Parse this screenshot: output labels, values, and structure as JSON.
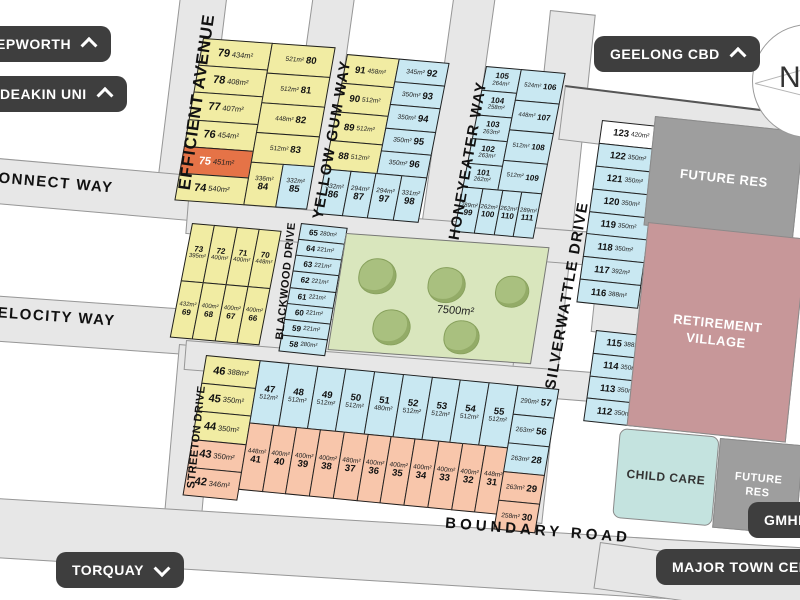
{
  "pills": {
    "epworth": {
      "label": "EPWORTH",
      "chevron": "up"
    },
    "deakin_uni": {
      "label": "DEAKIN UNI",
      "chevron": "up"
    },
    "geelong_cbd": {
      "label": "GEELONG CBD",
      "chevron": "up"
    },
    "torquay": {
      "label": "TORQUAY",
      "chevron": "down"
    },
    "gmhba": {
      "label": "GMHBA",
      "chevron": "none"
    },
    "major_town_centre": {
      "label": "MAJOR TOWN CENTRE",
      "chevron": "none"
    }
  },
  "streets": {
    "efficient_avenue": "EFFICIENT  AVENUE",
    "yellow_gum_way": "YELLOW GUM WAY",
    "honeyeater_way": "HONEYEATER WAY",
    "silverwattle_drive": "SILVERWATTLE DRIVE",
    "blackwood_drive": "BLACKWOOD DRIVE",
    "streeton_drive": "STREETON DRIVE",
    "connect_way": "CONNECT WAY",
    "velocity_way": "VELOCITY WAY",
    "boundary_road": "BOUNDARY  ROAD"
  },
  "parcels": {
    "future_res_top": "FUTURE RES",
    "retirement_village": "RETIREMENT VILLAGE",
    "child_care": "CHILD CARE",
    "future_res_bottom": "FUTURE RES"
  },
  "park": {
    "area": "7500m²",
    "tree_count": 5
  },
  "compass": {
    "label": "N"
  },
  "colors": {
    "yellow": "#f1eca3",
    "blue": "#c9e8f2",
    "orange": "#e57347",
    "pink": "#f8c6ab",
    "white": "#ffffff",
    "road": "#e7e7e7",
    "park": "#d9e6bd",
    "tree": "#a9c07f",
    "retirement": "#c79799",
    "future_res": "#9e9e9e",
    "child_care": "#c4e3df",
    "pill": "#3e3e3e"
  },
  "lot_groups": {
    "a_left": {
      "mode": "na",
      "cells": [
        {
          "n": "79",
          "a": "434m²",
          "c": "yellow"
        },
        {
          "n": "78",
          "a": "408m²",
          "c": "yellow"
        },
        {
          "n": "77",
          "a": "407m²",
          "c": "yellow"
        },
        {
          "n": "76",
          "a": "454m²",
          "c": "yellow"
        },
        {
          "n": "75",
          "a": "451m²",
          "c": "orange"
        },
        {
          "n": "74",
          "a": "540m²",
          "c": "yellow"
        }
      ]
    },
    "a_right": {
      "mode": "an",
      "cells": [
        {
          "n": "80",
          "a": "521m²",
          "c": "yellow"
        },
        {
          "n": "81",
          "a": "512m²",
          "c": "yellow"
        },
        {
          "n": "82",
          "a": "448m²",
          "c": "yellow"
        },
        {
          "n": "83",
          "a": "512m²",
          "c": "yellow"
        }
      ]
    },
    "a_rb": {
      "mode": "AN",
      "cells": [
        {
          "n": "84",
          "a": "336m²",
          "c": "yellow"
        },
        {
          "n": "85",
          "a": "332m²",
          "c": "blue"
        }
      ]
    },
    "b_left": {
      "mode": "na",
      "cells": [
        {
          "n": "91",
          "a": "458m²",
          "c": "yellow"
        },
        {
          "n": "90",
          "a": "512m²",
          "c": "yellow"
        },
        {
          "n": "89",
          "a": "512m²",
          "c": "yellow"
        },
        {
          "n": "88",
          "a": "512m²",
          "c": "yellow"
        }
      ]
    },
    "b_right": {
      "mode": "an",
      "cells": [
        {
          "n": "92",
          "a": "345m²",
          "c": "blue"
        },
        {
          "n": "93",
          "a": "350m²",
          "c": "blue"
        },
        {
          "n": "94",
          "a": "350m²",
          "c": "blue"
        },
        {
          "n": "95",
          "a": "350m²",
          "c": "blue"
        },
        {
          "n": "96",
          "a": "350m²",
          "c": "blue"
        }
      ]
    },
    "b_bottom": {
      "mode": "AN",
      "cells": [
        {
          "n": "86",
          "a": "332m²",
          "c": "blue"
        },
        {
          "n": "87",
          "a": "294m²",
          "c": "blue"
        },
        {
          "n": "97",
          "a": "294m²",
          "c": "blue"
        },
        {
          "n": "98",
          "a": "331m²",
          "c": "blue"
        }
      ]
    },
    "c_left": {
      "mode": "NA",
      "cells": [
        {
          "n": "105",
          "a": "264m²",
          "c": "blue"
        },
        {
          "n": "104",
          "a": "258m²",
          "c": "blue"
        },
        {
          "n": "103",
          "a": "263m²",
          "c": "blue"
        },
        {
          "n": "102",
          "a": "263m²",
          "c": "blue"
        },
        {
          "n": "101",
          "a": "262m²",
          "c": "blue"
        }
      ]
    },
    "c_right": {
      "mode": "an",
      "cells": [
        {
          "n": "106",
          "a": "524m²",
          "c": "blue"
        },
        {
          "n": "107",
          "a": "448m²",
          "c": "blue"
        },
        {
          "n": "108",
          "a": "512m²",
          "c": "blue"
        },
        {
          "n": "109",
          "a": "512m²",
          "c": "blue"
        }
      ]
    },
    "c_bottom": {
      "mode": "AN",
      "cells": [
        {
          "n": "99",
          "a": "289m²",
          "c": "blue"
        },
        {
          "n": "100",
          "a": "262m²",
          "c": "blue"
        },
        {
          "n": "110",
          "a": "262m²",
          "c": "blue"
        },
        {
          "n": "111",
          "a": "289m²",
          "c": "blue"
        }
      ]
    },
    "d_top": {
      "mode": "na",
      "cells": [
        {
          "n": "123",
          "a": "420m²",
          "c": "white"
        },
        {
          "n": "122",
          "a": "350m²",
          "c": "blue"
        },
        {
          "n": "121",
          "a": "350m²",
          "c": "blue"
        },
        {
          "n": "120",
          "a": "350m²",
          "c": "blue"
        },
        {
          "n": "119",
          "a": "350m²",
          "c": "blue"
        },
        {
          "n": "118",
          "a": "350m²",
          "c": "blue"
        },
        {
          "n": "117",
          "a": "392m²",
          "c": "blue"
        },
        {
          "n": "116",
          "a": "388m²",
          "c": "blue"
        }
      ]
    },
    "d_bottom": {
      "mode": "na",
      "cells": [
        {
          "n": "115",
          "a": "388m²",
          "c": "blue"
        },
        {
          "n": "114",
          "a": "350m²",
          "c": "blue"
        },
        {
          "n": "113",
          "a": "350m²",
          "c": "blue"
        },
        {
          "n": "112",
          "a": "350m²",
          "c": "blue"
        }
      ]
    },
    "e_row1": {
      "mode": "NA",
      "cells": [
        {
          "n": "73",
          "a": "395m²",
          "c": "yellow"
        },
        {
          "n": "72",
          "a": "400m²",
          "c": "yellow"
        },
        {
          "n": "71",
          "a": "400m²",
          "c": "yellow"
        },
        {
          "n": "70",
          "a": "448m²",
          "c": "yellow"
        }
      ]
    },
    "e_row2": {
      "mode": "AN",
      "cells": [
        {
          "n": "69",
          "a": "432m²",
          "c": "yellow"
        },
        {
          "n": "68",
          "a": "400m²",
          "c": "yellow"
        },
        {
          "n": "67",
          "a": "400m²",
          "c": "yellow"
        },
        {
          "n": "66",
          "a": "400m²",
          "c": "yellow"
        }
      ]
    },
    "f_col": {
      "mode": "na",
      "cells": [
        {
          "n": "65",
          "a": "280m²",
          "c": "blue"
        },
        {
          "n": "64",
          "a": "221m²",
          "c": "blue"
        },
        {
          "n": "63",
          "a": "221m²",
          "c": "blue"
        },
        {
          "n": "62",
          "a": "221m²",
          "c": "blue"
        },
        {
          "n": "61",
          "a": "221m²",
          "c": "blue"
        },
        {
          "n": "60",
          "a": "221m²",
          "c": "blue"
        },
        {
          "n": "59",
          "a": "221m²",
          "c": "blue"
        },
        {
          "n": "58",
          "a": "280m²",
          "c": "blue"
        }
      ]
    },
    "g_left": {
      "mode": "na",
      "cells": [
        {
          "n": "46",
          "a": "388m²",
          "c": "yellow"
        },
        {
          "n": "45",
          "a": "350m²",
          "c": "yellow"
        },
        {
          "n": "44",
          "a": "350m²",
          "c": "yellow"
        },
        {
          "n": "43",
          "a": "350m²",
          "c": "pink"
        },
        {
          "n": "42",
          "a": "346m²",
          "c": "pink"
        }
      ]
    },
    "g_row1": {
      "mode": "NA",
      "cells": [
        {
          "n": "47",
          "a": "512m²",
          "c": "blue"
        },
        {
          "n": "48",
          "a": "512m²",
          "c": "blue"
        },
        {
          "n": "49",
          "a": "512m²",
          "c": "blue"
        },
        {
          "n": "50",
          "a": "512m²",
          "c": "blue"
        },
        {
          "n": "51",
          "a": "480m²",
          "c": "blue"
        },
        {
          "n": "52",
          "a": "512m²",
          "c": "blue"
        },
        {
          "n": "53",
          "a": "512m²",
          "c": "blue"
        },
        {
          "n": "54",
          "a": "512m²",
          "c": "blue"
        },
        {
          "n": "55",
          "a": "512m²",
          "c": "blue"
        }
      ]
    },
    "g_row2": {
      "mode": "AN",
      "cells": [
        {
          "n": "41",
          "a": "448m²",
          "c": "pink"
        },
        {
          "n": "40",
          "a": "400m²",
          "c": "pink"
        },
        {
          "n": "39",
          "a": "400m²",
          "c": "pink"
        },
        {
          "n": "38",
          "a": "400m²",
          "c": "pink"
        },
        {
          "n": "37",
          "a": "480m²",
          "c": "pink"
        },
        {
          "n": "36",
          "a": "400m²",
          "c": "pink"
        },
        {
          "n": "35",
          "a": "400m²",
          "c": "pink"
        },
        {
          "n": "34",
          "a": "400m²",
          "c": "pink"
        },
        {
          "n": "33",
          "a": "400m²",
          "c": "pink"
        },
        {
          "n": "32",
          "a": "400m²",
          "c": "pink"
        },
        {
          "n": "31",
          "a": "448m²",
          "c": "pink"
        }
      ]
    },
    "g_right": {
      "mode": "an",
      "cells": [
        {
          "n": "57",
          "a": "290m²",
          "c": "blue"
        },
        {
          "n": "56",
          "a": "263m²",
          "c": "blue"
        },
        {
          "n": "28",
          "a": "263m²",
          "c": "blue"
        },
        {
          "n": "29",
          "a": "263m²",
          "c": "pink"
        },
        {
          "n": "30",
          "a": "258m²",
          "c": "pink"
        }
      ]
    }
  }
}
